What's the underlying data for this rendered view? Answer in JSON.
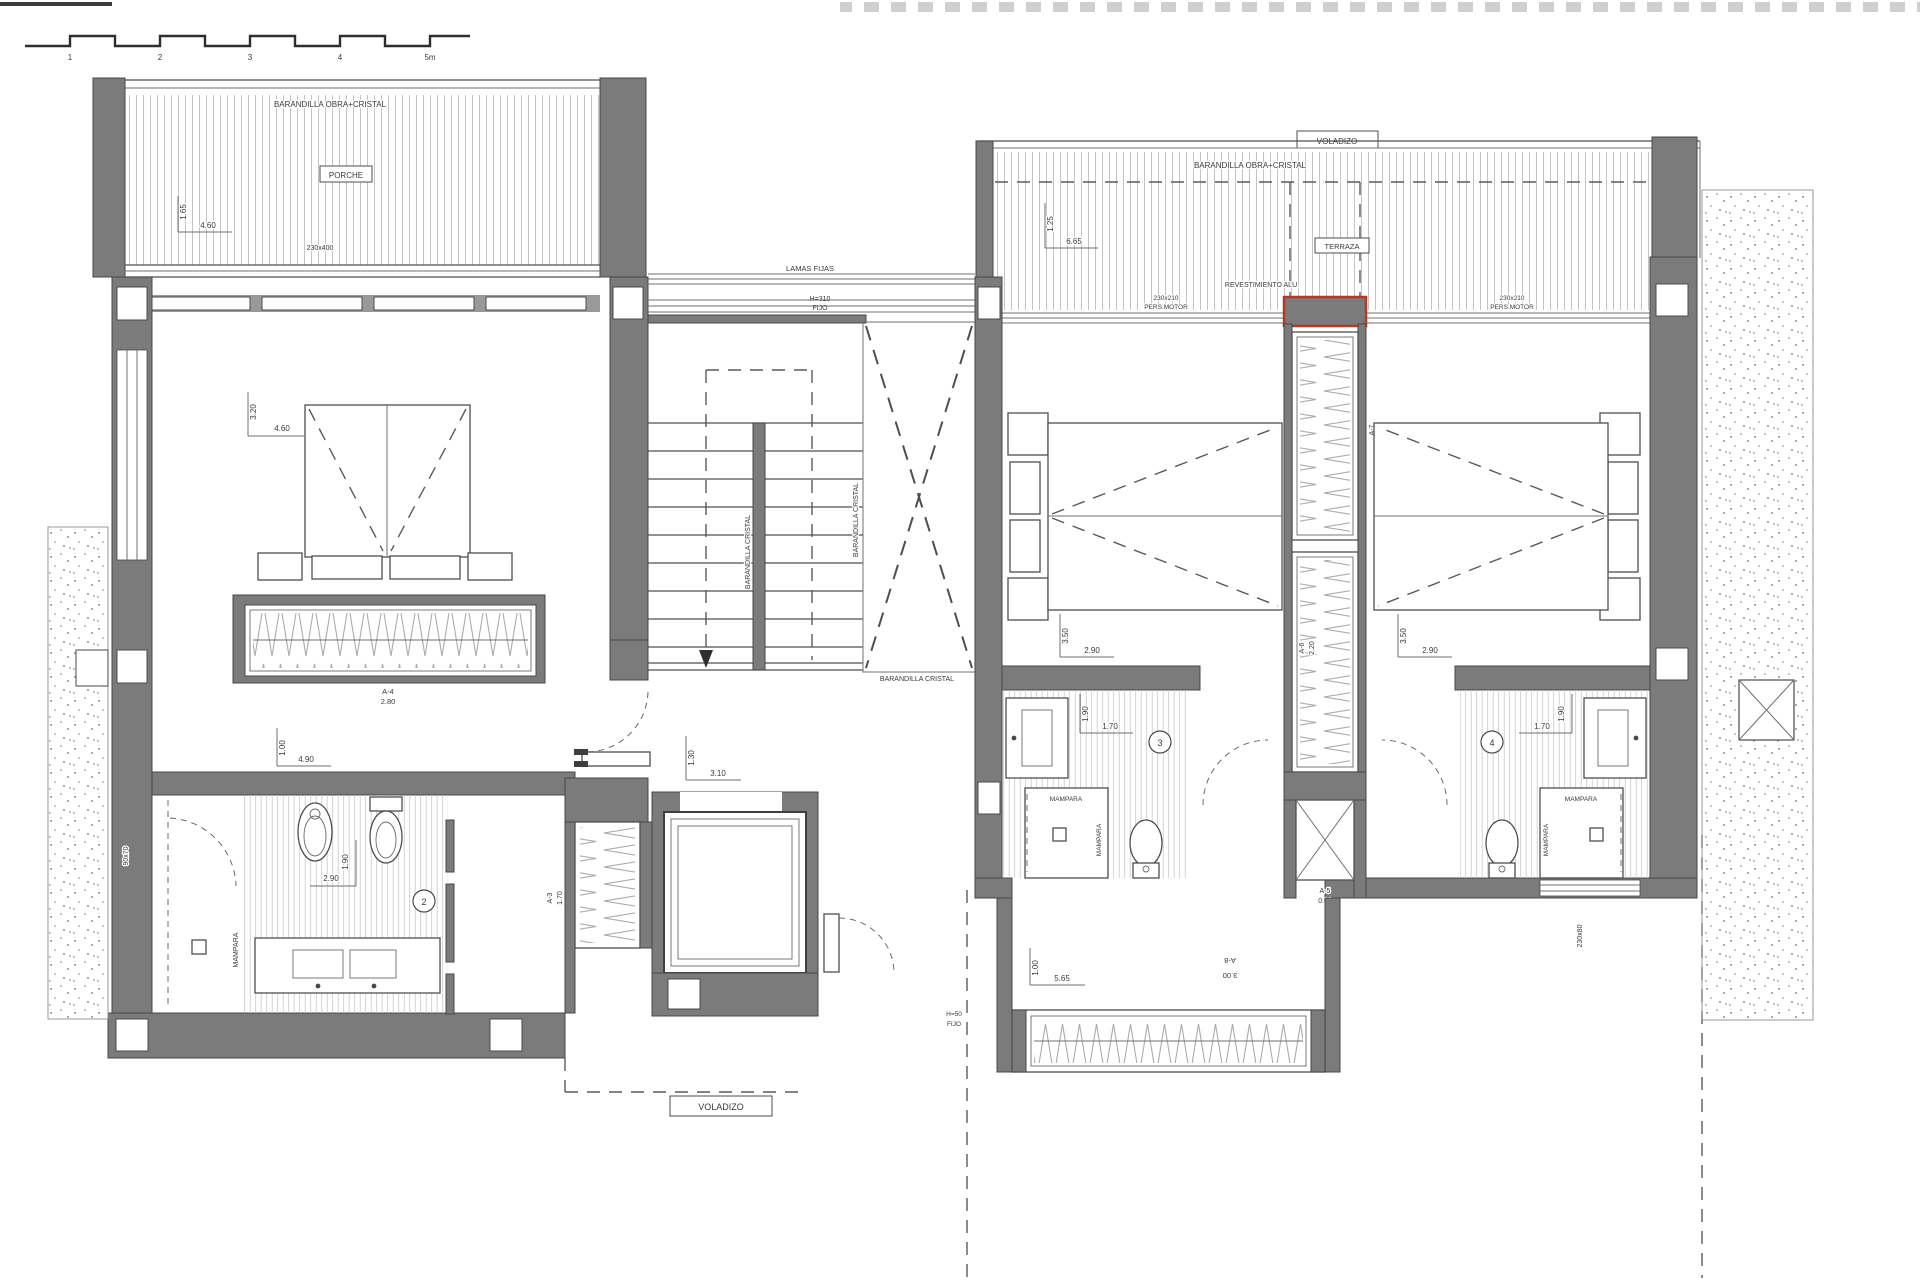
{
  "colors": {
    "wall": "#7b7b7b",
    "cladding_red": "#b23a27",
    "paper": "#ffffff"
  },
  "plan": {
    "scale_bar": {
      "ticks": [
        "1",
        "2",
        "3",
        "4",
        "5m"
      ]
    },
    "porch": {
      "railing": "BARANDILLA OBRA+CRISTAL",
      "name": "PORCHE",
      "dim_depth": "1.65",
      "dim_width": "4.60",
      "window": "230x400"
    },
    "north_facade": {
      "lamas": "LAMAS FIJAS",
      "height": "H=310",
      "fixed": "FIJO"
    },
    "master_bedroom": {
      "dim_depth": "3.20",
      "dim_width": "4.60",
      "wardrobe": {
        "code": "A-4",
        "width": "2.80"
      },
      "pass": {
        "dim_depth": "1.00",
        "dim_width": "4.90"
      }
    },
    "bath_2": {
      "num": "2",
      "dim_depth": "1.90",
      "dim_width": "2.90",
      "screen": "MAMPARA",
      "shower": "90x70"
    },
    "stairs": {
      "rail_a": "BARANDILLA CRISTAL",
      "rail_b": "BARANDILLA CRISTAL",
      "rail_c": "BARANDILLA CRISTAL"
    },
    "hall": {
      "dim_depth": "1.30",
      "dim_width": "3.10",
      "closet": {
        "code": "A-3",
        "width": "1.70"
      }
    },
    "terrace": {
      "voladizo": "VOLADIZO",
      "railing": "BARANDILLA OBRA+CRISTAL",
      "name": "TERRAZA",
      "dim_depth": "1.25",
      "dim_width": "6.65",
      "cladding": "REVESTIMIENTO ALU.",
      "window_l": {
        "size": "230x210",
        "type": "PERS.MOTOR"
      },
      "window_r": {
        "size": "230x210",
        "type": "PERS.MOTOR"
      }
    },
    "bedroom_3": {
      "dim_depth": "3.50",
      "dim_width": "2.90"
    },
    "bath_3": {
      "num": "3",
      "dim_depth": "1.90",
      "dim_width": "1.70",
      "screen_a": "MAMPARA",
      "screen_b": "MAMPARA"
    },
    "bedroom_4": {
      "dim_depth": "3.50",
      "dim_width": "2.90"
    },
    "bath_4": {
      "num": "4",
      "dim_depth": "1.90",
      "dim_width": "1.70",
      "screen_a": "MAMPARA",
      "screen_b": "MAMPARA",
      "window": "230x80"
    },
    "core": {
      "closet_top": {
        "code": "A-7",
        "width": "2.20"
      },
      "closet_mid": {
        "code": "A-6",
        "width": "2.20"
      },
      "shaft": {
        "code": "A-5",
        "level": "0.00"
      }
    },
    "south": {
      "dim_depth": "1.00",
      "dim_width": "5.65",
      "window": {
        "code": "A-8",
        "width": "3.00"
      },
      "height": "H=50",
      "fixed": "FIJO",
      "voladizo": "VOLADIZO"
    }
  }
}
